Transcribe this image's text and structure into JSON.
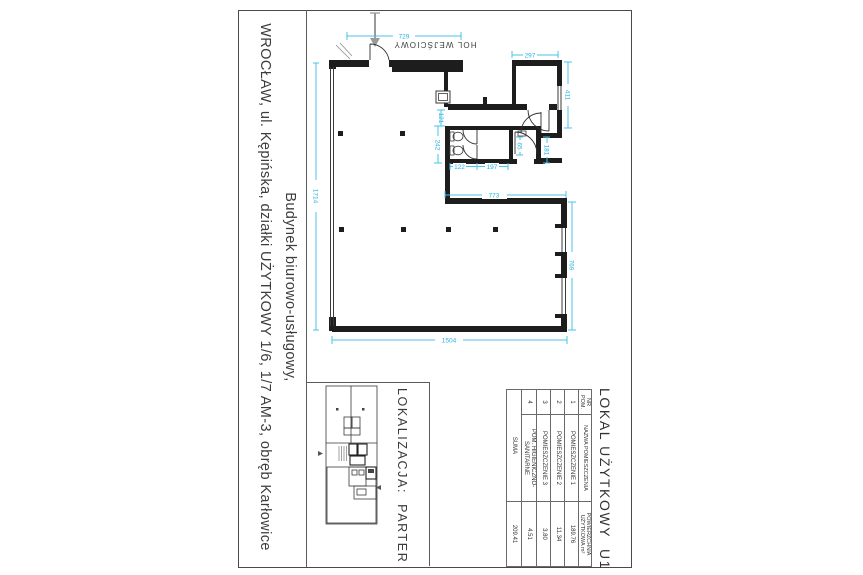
{
  "sheet": {
    "title_line1": "Budynek biurowo-usługowy,",
    "title_line2": "WROCŁAW, ul. Kępińska, działki UŻYTKOWY 1/6, 1/7 AM-3, obręb Karłowice"
  },
  "plan": {
    "hall_label": "HOL WEJŚCIOWY",
    "dims": {
      "entry_width": "729",
      "left_total": "1714",
      "bottom_total": "1504",
      "inner_width": "773",
      "right_lower": "769",
      "room2_width": "297",
      "room2_height": "411",
      "stall_block_height": "242",
      "opening": "121",
      "stall_width": "122",
      "stall_width2": "197",
      "niche_width": "65",
      "niche_height": "181"
    }
  },
  "localization": {
    "label": "LOKALIZACJA:  PARTER"
  },
  "area_table": {
    "title": "LOKAL UŻYTKOWY  U1",
    "headers": {
      "nr": "NR POM.",
      "name": "NAZWA POMIESZCZENIA",
      "area": "POWIERZCHNIA UŻYTKOWA m²"
    },
    "rows": [
      {
        "nr": "1",
        "name": "POMIESZCZENIE 1",
        "area": "189.76"
      },
      {
        "nr": "2",
        "name": "POMIESZCZENIE 2",
        "area": "11.34"
      },
      {
        "nr": "3",
        "name": "POMIESZCZENIE 3",
        "area": "3.80"
      },
      {
        "nr": "4",
        "name": "POM. HIGIENICZNO-SANITARNE",
        "area": "4.51"
      }
    ],
    "total_label": "SUMA",
    "total_value": "209.41"
  },
  "colors": {
    "dimension": "#49c3eb",
    "wall": "#1d1d1d",
    "text": "#3d3d3d"
  }
}
